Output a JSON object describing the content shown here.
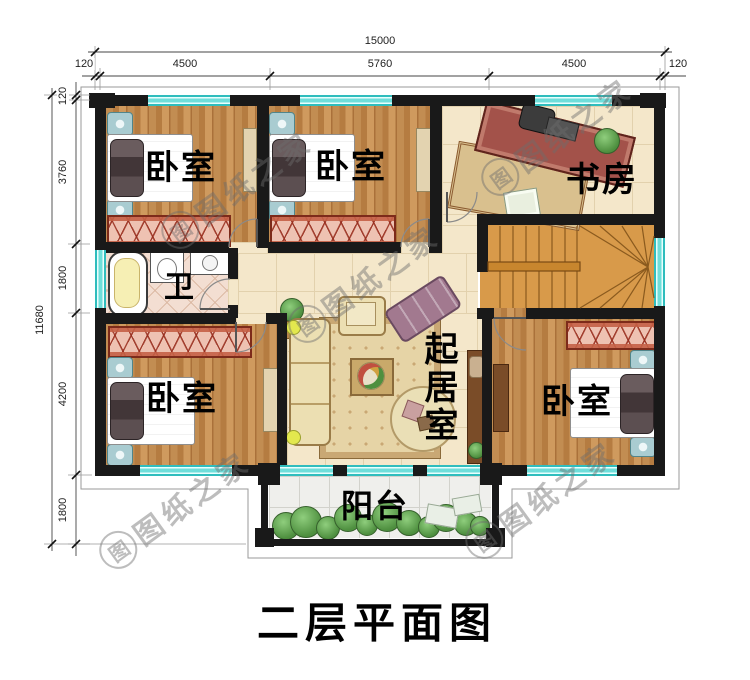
{
  "title": "二层平面图",
  "watermark": {
    "logo_char": "图",
    "text": "图纸之家"
  },
  "dimensions": {
    "top": {
      "total": "15000",
      "left_offset": "120",
      "bay1": "4500",
      "bay2": "5760",
      "bay3": "4500",
      "right_offset": "120"
    },
    "left": {
      "total": "11680",
      "top_offset": "120",
      "bay1": "3760",
      "bay2": "1800",
      "bay3": "4200",
      "bay4": "1800"
    }
  },
  "rooms": {
    "bedroom_top_left": "卧室",
    "bedroom_top_middle": "卧室",
    "study": "书房",
    "bathroom": "卫",
    "living_room": "起居室",
    "bedroom_bottom_left": "卧室",
    "bedroom_bottom_right": "卧室",
    "balcony": "阳台"
  },
  "colors": {
    "wall": "#191919",
    "window_glass": "#6fdeda",
    "wood_floor": "#c08a4e",
    "tile_floor": "#f3e6c9",
    "bath_tile": "#f2ddd0",
    "balcony_tile": "#efefec",
    "wardrobe": "#eec2b2",
    "stair_wood": "#d89a4a",
    "dimension_text": "#222222",
    "label_text": "#000000",
    "watermark_gray": "#6c6c6c"
  }
}
